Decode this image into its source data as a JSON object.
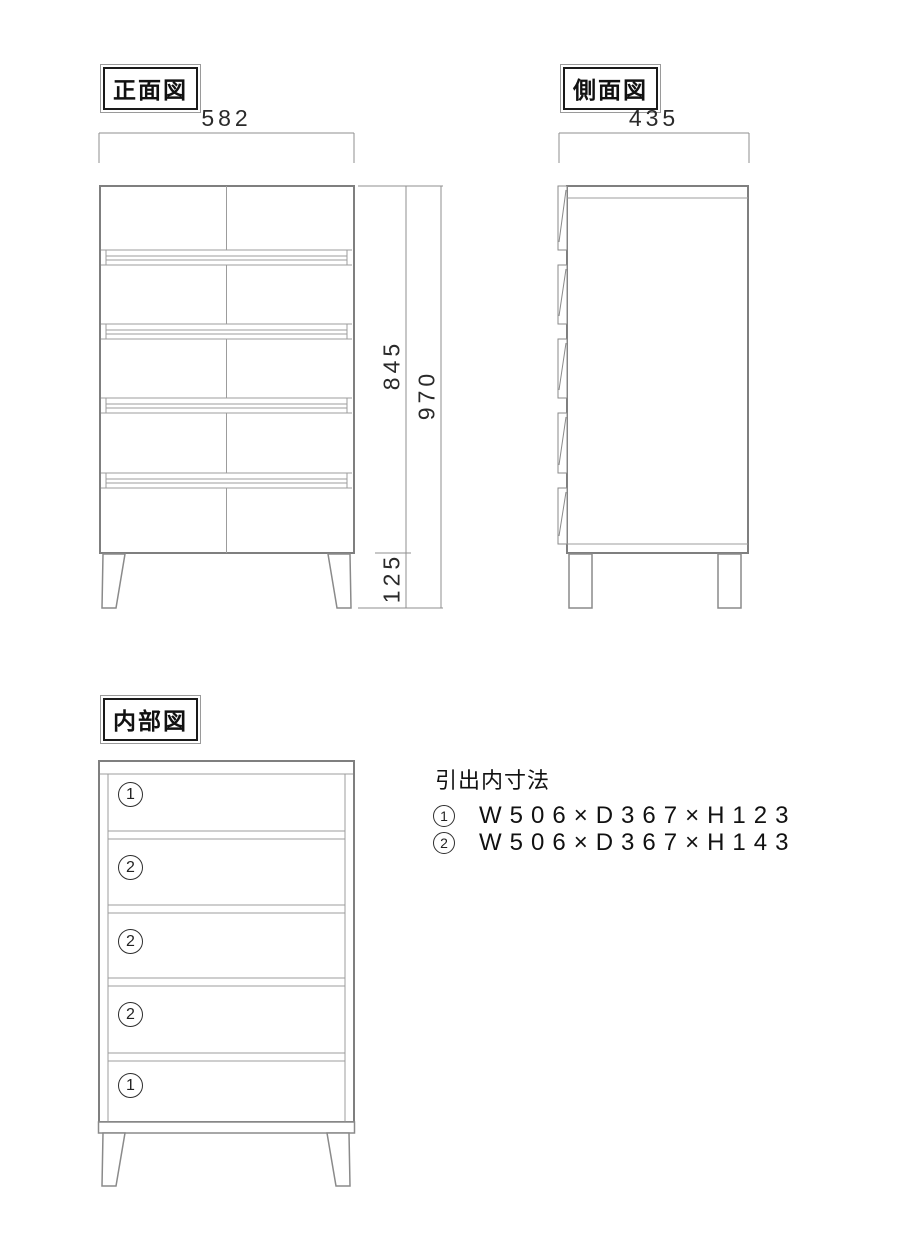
{
  "front_view": {
    "label": "正面図",
    "width_dim": "582",
    "body_height_dim": "845",
    "total_height_dim": "970",
    "leg_height_dim": "125"
  },
  "side_view": {
    "label": "側面図",
    "depth_dim": "435"
  },
  "internal_view": {
    "label": "内部図",
    "compartments": [
      {
        "num": "1"
      },
      {
        "num": "2"
      },
      {
        "num": "2"
      },
      {
        "num": "2"
      },
      {
        "num": "1"
      }
    ]
  },
  "drawer_specs": {
    "title": "引出内寸法",
    "items": [
      {
        "num": "1",
        "dims": "W506×D367×H123"
      },
      {
        "num": "2",
        "dims": "W506×D367×H143"
      }
    ]
  },
  "colors": {
    "outline": "#7f7f7f",
    "inner_line": "#9c9c9c",
    "dim_line": "#8f8f8f",
    "text": "#1c1c1c"
  }
}
